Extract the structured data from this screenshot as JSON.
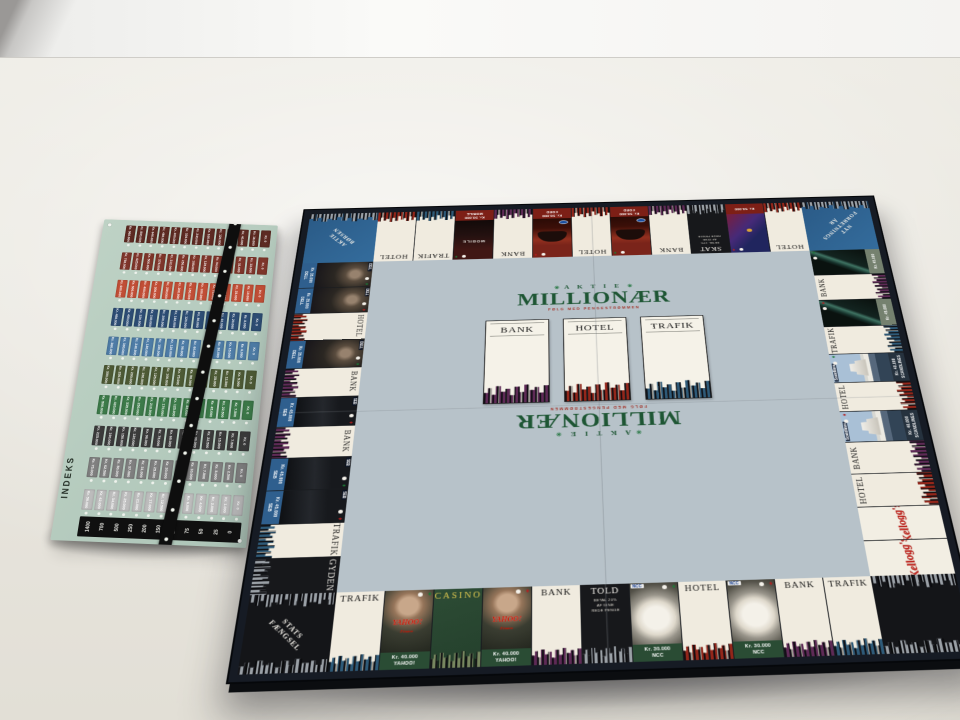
{
  "palette": {
    "bank": "#5e2a56",
    "hotel": "#93261a",
    "trafik": "#2e5a78",
    "corner_sky": "#9aa0a6",
    "board_field": "#b7c2c9",
    "logo_green": "#1e5634",
    "logo_red": "#a3342a",
    "sheet_bg": "#b9cfc2"
  },
  "board": {
    "center": {
      "flourish": "✳",
      "brand_small": "A K T I E",
      "brand_main": "MILLIONÆR",
      "brand_sub": "FØLG MED PENGESTRØMMEN",
      "cards": [
        {
          "title": "BANK",
          "sky": "#5e2a56"
        },
        {
          "title": "HOTEL",
          "sky": "#93261a"
        },
        {
          "title": "TRAFIK",
          "sky": "#2e5a78"
        }
      ]
    },
    "top": [
      {
        "kind": "corner",
        "style": "blue",
        "lines": [
          "AKTIE",
          "BØRSEN"
        ],
        "rot": -135,
        "skyTop": true,
        "skyBottom": false
      },
      {
        "kind": "plain",
        "label": "HOTEL",
        "sky": "hotel"
      },
      {
        "kind": "plain",
        "label": "TRAFIK",
        "sky": "trafik"
      },
      {
        "kind": "brand",
        "photo": "mobile",
        "ptext": "MOBILE",
        "price": "Kr. 50.000",
        "name": "MOBILE",
        "band": "red",
        "mark": "green"
      },
      {
        "kind": "plain",
        "label": "BANK",
        "sky": "bank"
      },
      {
        "kind": "brand",
        "photo": "ford",
        "price": "Kr. 50.000",
        "name": "FORD",
        "band": "red",
        "mark": "red"
      },
      {
        "kind": "plain",
        "label": "HOTEL",
        "sky": "hotel"
      },
      {
        "kind": "brand",
        "photo": "ford",
        "price": "Kr. 50.000",
        "name": "FORD",
        "band": "red",
        "mark": "green"
      },
      {
        "kind": "plain",
        "label": "BANK",
        "sky": "bank"
      },
      {
        "kind": "special",
        "label": "SKAT",
        "sub": [
          "BETAL 10%",
          "AF DINE",
          "REDE PENGE"
        ]
      },
      {
        "kind": "brand",
        "photo": "card",
        "price": "Kr. 50.000",
        "name": "",
        "band": "red",
        "mark": "red"
      },
      {
        "kind": "plain",
        "label": "HOTEL",
        "sky": "hotel"
      },
      {
        "kind": "corner",
        "style": "blue",
        "lines": [
          "NYT",
          "FORRETNINGS",
          "ÅR"
        ],
        "rot": 135,
        "skyTop": true,
        "skyBottom": false
      }
    ],
    "bottom": [
      {
        "kind": "corner",
        "style": "dark",
        "lines": [
          "STATS",
          "FÆNGSEL"
        ],
        "rot": 45,
        "skyTop": true,
        "skyBottom": true
      },
      {
        "kind": "plain",
        "label": "TRAFIK",
        "sky": "trafik"
      },
      {
        "kind": "brand",
        "photo": "yahoo",
        "ptext": "YAHOO!",
        "ptext2": "Finans",
        "price": "Kr. 40.000",
        "name": "YAHOO!",
        "band": "green",
        "mark": "green"
      },
      {
        "kind": "casino",
        "label": "CASINO"
      },
      {
        "kind": "brand",
        "photo": "yahoo",
        "ptext": "YAHOO!",
        "ptext2": "Finans",
        "price": "Kr. 40.000",
        "name": "YAHOO!",
        "band": "green",
        "mark": "red"
      },
      {
        "kind": "plain",
        "label": "BANK",
        "sky": "bank"
      },
      {
        "kind": "special",
        "label": "TOLD",
        "sub": [
          "BETAL 20%",
          "AF DINE",
          "REDE PENGE"
        ]
      },
      {
        "kind": "brand",
        "photo": "helmet",
        "tag": "NCC",
        "price": "Kr. 30.000",
        "name": "NCC",
        "band": "green",
        "mark": "green"
      },
      {
        "kind": "plain",
        "label": "HOTEL",
        "sky": "hotel"
      },
      {
        "kind": "brand",
        "photo": "helmet",
        "tag": "NCC",
        "price": "Kr. 30.000",
        "name": "NCC",
        "band": "green",
        "mark": "red"
      },
      {
        "kind": "plain",
        "label": "BANK",
        "sky": "bank"
      },
      {
        "kind": "plain",
        "label": "TRAFIK",
        "sky": "trafik"
      },
      {
        "kind": "corner",
        "style": "dark",
        "lines": [],
        "rot": -45,
        "skyTop": true,
        "skyBottom": true
      }
    ],
    "left": [
      {
        "kind": "brand",
        "photo": "suit",
        "tag": "DELL",
        "price": "Kr. 35.000",
        "name": "DELL",
        "band": "blue",
        "mark": "green"
      },
      {
        "kind": "brand",
        "photo": "suit",
        "tag": "DELL",
        "price": "Kr. 35.000",
        "name": "DELL",
        "band": "blue",
        "mark": "red"
      },
      {
        "kind": "plain",
        "label": "HOTEL",
        "sky": "hotel"
      },
      {
        "kind": "brand",
        "photo": "suit",
        "tag": "DELL",
        "price": "Kr. 35.000",
        "name": "DELL",
        "band": "blue",
        "mark": "green"
      },
      {
        "kind": "plain",
        "label": "BANK",
        "sky": "bank"
      },
      {
        "kind": "brand",
        "photo": "sebdark",
        "tag": "SEB",
        "price": "Kr. 45.000",
        "name": "SEB",
        "band": "blue",
        "mark": "red"
      },
      {
        "kind": "plain",
        "label": "BANK",
        "sky": "bank"
      },
      {
        "kind": "brand",
        "photo": "sebdark",
        "tag": "SEB",
        "price": "Kr. 45.000",
        "name": "SEB",
        "band": "blue",
        "mark": "green"
      },
      {
        "kind": "brand",
        "photo": "sebdark",
        "tag": "SEB",
        "price": "Kr. 45.000",
        "name": "SEB",
        "band": "blue",
        "mark": "red"
      },
      {
        "kind": "plain",
        "label": "TRAFIK",
        "sky": "trafik"
      },
      {
        "kind": "special",
        "label": "GYDEN",
        "sub": []
      }
    ],
    "right": [
      {
        "kind": "brand",
        "photo": "teal",
        "price": "Kr. 45.000",
        "name": "",
        "band": "gray",
        "mark": "green"
      },
      {
        "kind": "plain",
        "label": "BANK",
        "sky": "bank"
      },
      {
        "kind": "brand",
        "photo": "teal",
        "price": "Kr. 45.000",
        "name": "",
        "band": "gray",
        "mark": "red"
      },
      {
        "kind": "plain",
        "label": "TRAFIK",
        "sky": "trafik"
      },
      {
        "kind": "brand",
        "photo": "ship",
        "tag": "Scandlines",
        "price": "Kr. 40.000",
        "name": "SCANDLINES",
        "band": "navy",
        "mark": "green"
      },
      {
        "kind": "plain",
        "label": "HOTEL",
        "sky": "hotel"
      },
      {
        "kind": "brand",
        "photo": "ship",
        "tag": "Scandlines",
        "price": "Kr. 40.000",
        "name": "SCANDLINES",
        "band": "navy",
        "mark": "red"
      },
      {
        "kind": "plain",
        "label": "BANK",
        "sky": "bank"
      },
      {
        "kind": "plain",
        "label": "HOTEL",
        "sky": "hotel"
      },
      {
        "kind": "kelloggs",
        "label": "Kellogg's"
      },
      {
        "kind": "kelloggs",
        "label": "Kellogg's"
      }
    ]
  },
  "sheet": {
    "index_label": "INDEKS",
    "scale": [
      "1400",
      "700",
      "500",
      "250",
      "200",
      "150",
      "100",
      "75",
      "50",
      "25",
      "0"
    ],
    "rows": [
      {
        "color": "#5d2a22",
        "values": [
          "Kr. 960.000",
          "Kr. 800.000",
          "Kr. 640.000",
          "Kr. 480.000",
          "Kr. 400.000",
          "Kr. 320.000",
          "Kr. 240.000",
          "Kr. 160.000",
          "Kr. 120.000",
          "Kr. 80.000",
          "Kr. 40.000",
          "Kr. 16.000",
          "Kr. 0"
        ]
      },
      {
        "color": "#7e352a",
        "values": [
          "Kr. 750.000",
          "Kr. 625.000",
          "Kr. 500.000",
          "Kr. 375.000",
          "Kr. 312.000",
          "Kr. 250.000",
          "Kr. 188.000",
          "Kr. 125.000",
          "Kr. 94.000",
          "Kr. 63.000",
          "Kr. 31.000",
          "Kr. 13.000",
          "Kr. 0"
        ]
      },
      {
        "color": "#c14e36",
        "values": [
          "Kr. 600.000",
          "Kr. 500.000",
          "Kr. 400.000",
          "Kr. 300.000",
          "Kr. 250.000",
          "Kr. 200.000",
          "Kr. 150.000",
          "Kr. 100.000",
          "Kr. 75.000",
          "Kr. 50.000",
          "Kr. 25.000",
          "Kr. 10.000",
          "Kr. 0"
        ]
      },
      {
        "color": "#2d4d74",
        "values": [
          "Kr. 480.000",
          "Kr. 400.000",
          "Kr. 320.000",
          "Kr. 240.000",
          "Kr. 200.000",
          "Kr. 160.000",
          "Kr. 120.000",
          "Kr. 80.000",
          "Kr. 60.000",
          "Kr. 40.000",
          "Kr. 20.000",
          "Kr. 8.000",
          "Kr. 0"
        ]
      },
      {
        "color": "#4e7ca6",
        "values": [
          "Kr. 360.000",
          "Kr. 300.000",
          "Kr. 240.000",
          "Kr. 180.000",
          "Kr. 150.000",
          "Kr. 120.000",
          "Kr. 90.000",
          "Kr. 60.000",
          "Kr. 45.000",
          "Kr. 30.000",
          "Kr. 15.000",
          "Kr. 6.000",
          "Kr. 0"
        ]
      },
      {
        "color": "#4d5a35",
        "values": [
          "Kr. 300.000",
          "Kr. 250.000",
          "Kr. 200.000",
          "Kr. 150.000",
          "Kr. 125.000",
          "Kr. 100.000",
          "Kr. 75.000",
          "Kr. 50.000",
          "Kr. 37.500",
          "Kr. 25.000",
          "Kr. 12.500",
          "Kr. 5.000",
          "Kr. 0"
        ]
      },
      {
        "color": "#3c7a49",
        "values": [
          "Kr. 500.000",
          "Kr. 420.000",
          "Kr. 335.000",
          "Kr. 250.000",
          "Kr. 210.000",
          "Kr. 170.000",
          "Kr. 125.000",
          "Kr. 85.000",
          "Kr. 62.500",
          "Kr. 45.000",
          "Kr. 22.500",
          "Kr. 7.500",
          "Kr. 0"
        ]
      },
      {
        "color": "#3b3b3b",
        "values": [
          "Kr. 225.000",
          "Kr. 190.000",
          "Kr. 150.000",
          "Kr. 120.000",
          "Kr. 90.000",
          "Kr. 75.000",
          "Kr. 60.000",
          "Kr. 45.000",
          "Kr. 30.000",
          "Kr. 22.500",
          "Kr. 15.000",
          "Kr. 7.500",
          "Kr. 0"
        ]
      },
      {
        "color": "#7f7f7f",
        "values": [
          "Kr. 75.000",
          "Kr. 62.500",
          "Kr. 50.000",
          "Kr. 37.500",
          "Kr. 31.000",
          "Kr. 25.000",
          "Kr. 20.000",
          "Kr. 15.000",
          "Kr. 10.000",
          "Kr. 7.500",
          "Kr. 5.000",
          "Kr. 2.500",
          "Kr. 0"
        ]
      },
      {
        "color": "#bcbcbc",
        "values": [
          "Kr. 50.000",
          "Kr. 42.000",
          "Kr. 34.000",
          "Kr. 25.000",
          "Kr. 21.000",
          "Kr. 17.000",
          "Kr. 12.500",
          "Kr. 8.500",
          "Kr. 6.000",
          "Kr. 4.000",
          "Kr. 2.000",
          "Kr. 1.000",
          "Kr. 0"
        ]
      }
    ]
  }
}
